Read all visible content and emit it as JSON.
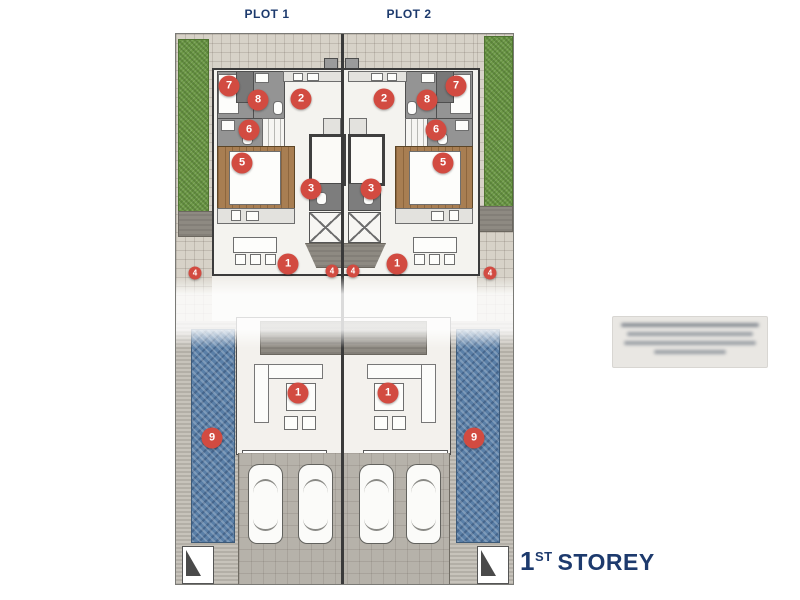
{
  "labels": {
    "plot1": "PLOT 1",
    "plot2": "PLOT 2",
    "storey_num": "1",
    "storey_sup": "ST",
    "storey_word": "STOREY"
  },
  "colors": {
    "navy": "#1d3a6d",
    "marker-red": "#d24b41",
    "hedge-green": "#6d9947",
    "pool-blue": "#5a7fa7",
    "wood-brown": "#a87e52"
  },
  "plan": {
    "markers": [
      {
        "label": "7",
        "x": 53,
        "y": 52,
        "size": "large"
      },
      {
        "label": "7",
        "x": 280,
        "y": 52,
        "size": "large"
      },
      {
        "label": "8",
        "x": 82,
        "y": 66,
        "size": "large"
      },
      {
        "label": "8",
        "x": 251,
        "y": 66,
        "size": "large"
      },
      {
        "label": "2",
        "x": 125,
        "y": 65,
        "size": "large"
      },
      {
        "label": "2",
        "x": 208,
        "y": 65,
        "size": "large"
      },
      {
        "label": "6",
        "x": 73,
        "y": 96,
        "size": "large"
      },
      {
        "label": "6",
        "x": 260,
        "y": 96,
        "size": "large"
      },
      {
        "label": "5",
        "x": 66,
        "y": 129,
        "size": "large"
      },
      {
        "label": "5",
        "x": 267,
        "y": 129,
        "size": "large"
      },
      {
        "label": "3",
        "x": 135,
        "y": 155,
        "size": "large"
      },
      {
        "label": "3",
        "x": 195,
        "y": 155,
        "size": "large"
      },
      {
        "label": "1",
        "x": 112,
        "y": 230,
        "size": "large"
      },
      {
        "label": "1",
        "x": 221,
        "y": 230,
        "size": "large"
      },
      {
        "label": "4",
        "x": 156,
        "y": 237,
        "size": "small"
      },
      {
        "label": "4",
        "x": 177,
        "y": 237,
        "size": "small"
      },
      {
        "label": "4",
        "x": 19,
        "y": 239,
        "size": "small"
      },
      {
        "label": "4",
        "x": 314,
        "y": 239,
        "size": "small"
      },
      {
        "label": "1",
        "x": 122,
        "y": 359,
        "size": "large"
      },
      {
        "label": "1",
        "x": 212,
        "y": 359,
        "size": "large"
      },
      {
        "label": "9",
        "x": 36,
        "y": 404,
        "size": "large"
      },
      {
        "label": "9",
        "x": 298,
        "y": 404,
        "size": "large"
      }
    ]
  }
}
